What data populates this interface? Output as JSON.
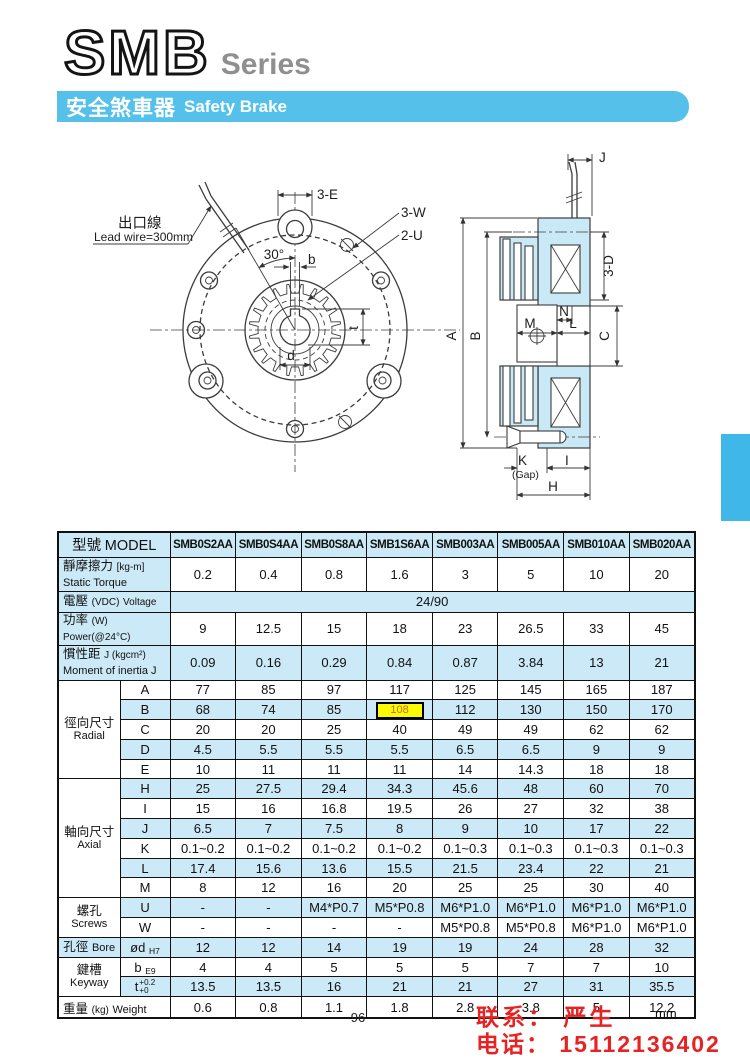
{
  "header": {
    "series": "SMB",
    "series_suffix": "Series",
    "banner_zh": "安全煞車器",
    "banner_en": "Safety Brake"
  },
  "drawings": {
    "lead_wire_label_zh": "出口線",
    "lead_wire_label_en": "Lead wire=300mm",
    "front_view": {
      "dim_3e": "3-E",
      "dim_3w": "3-W",
      "dim_2u": "2-U",
      "angle_30": "30°",
      "dim_b": "b",
      "dim_d": "d",
      "dim_t": "t"
    },
    "section_view": {
      "dim_j": "J",
      "dim_3d": "3-D",
      "dim_a": "A",
      "dim_b": "B",
      "dim_n": "N",
      "dim_m": "M",
      "dim_l": "L",
      "dim_c": "C",
      "dim_k": "K",
      "gap": "(Gap)",
      "dim_i": "I",
      "dim_h": "H"
    }
  },
  "table": {
    "header": {
      "zh": "型號",
      "en": "MODEL"
    },
    "models": [
      "SMB0S2AA",
      "SMB0S4AA",
      "SMB0S8AA",
      "SMB1S6AA",
      "SMB003AA",
      "SMB005AA",
      "SMB010AA",
      "SMB020AA"
    ],
    "spec_rows": [
      {
        "id": "static-torque",
        "label": {
          "zh": "靜摩擦力",
          "unit": "[kg-m]",
          "en": "Static Torque",
          "two_line": true
        },
        "values": [
          "0.2",
          "0.4",
          "0.8",
          "1.6",
          "3",
          "5",
          "10",
          "20"
        ]
      },
      {
        "id": "voltage",
        "label": {
          "zh": "電壓",
          "unit": "(VDC)",
          "en": "Voltage"
        },
        "span_value": "24/90"
      },
      {
        "id": "power",
        "label": {
          "zh": "功率",
          "unit": "(W)",
          "en": "Power(@24°C)"
        },
        "values": [
          "9",
          "12.5",
          "15",
          "18",
          "23",
          "26.5",
          "33",
          "45"
        ]
      },
      {
        "id": "inertia",
        "label": {
          "zh": "慣性距",
          "unit": "J (kgcm²)",
          "en": "Moment of inertia J",
          "two_line": true
        },
        "values": [
          "0.09",
          "0.16",
          "0.29",
          "0.84",
          "0.87",
          "3.84",
          "13",
          "21"
        ]
      }
    ],
    "groups": [
      {
        "zh": "徑向尺寸",
        "en": "Radial",
        "rows": [
          {
            "key": "A",
            "values": [
              "77",
              "85",
              "97",
              "117",
              "125",
              "145",
              "165",
              "187"
            ]
          },
          {
            "key": "B",
            "values": [
              "68",
              "74",
              "85",
              "108",
              "112",
              "130",
              "150",
              "170"
            ],
            "highlight": 3
          },
          {
            "key": "C",
            "values": [
              "20",
              "20",
              "25",
              "40",
              "49",
              "49",
              "62",
              "62"
            ]
          },
          {
            "key": "D",
            "values": [
              "4.5",
              "5.5",
              "5.5",
              "5.5",
              "6.5",
              "6.5",
              "9",
              "9"
            ]
          },
          {
            "key": "E",
            "values": [
              "10",
              "11",
              "11",
              "11",
              "14",
              "14.3",
              "18",
              "18"
            ]
          }
        ]
      },
      {
        "zh": "軸向尺寸",
        "en": "Axial",
        "rows": [
          {
            "key": "H",
            "values": [
              "25",
              "27.5",
              "29.4",
              "34.3",
              "45.6",
              "48",
              "60",
              "70"
            ]
          },
          {
            "key": "I",
            "values": [
              "15",
              "16",
              "16.8",
              "19.5",
              "26",
              "27",
              "32",
              "38"
            ]
          },
          {
            "key": "J",
            "values": [
              "6.5",
              "7",
              "7.5",
              "8",
              "9",
              "10",
              "17",
              "22"
            ]
          },
          {
            "key": "K",
            "values": [
              "0.1~0.2",
              "0.1~0.2",
              "0.1~0.2",
              "0.1~0.2",
              "0.1~0.3",
              "0.1~0.3",
              "0.1~0.3",
              "0.1~0.3"
            ]
          },
          {
            "key": "L",
            "values": [
              "17.4",
              "15.6",
              "13.6",
              "15.5",
              "21.5",
              "23.4",
              "22",
              "21"
            ]
          },
          {
            "key": "M",
            "values": [
              "8",
              "12",
              "16",
              "20",
              "25",
              "25",
              "30",
              "40"
            ]
          }
        ]
      },
      {
        "zh": "螺孔",
        "en": "Screws",
        "rows": [
          {
            "key": "U",
            "values": [
              "-",
              "-",
              "M4*P0.7",
              "M5*P0.8",
              "M6*P1.0",
              "M6*P1.0",
              "M6*P1.0",
              "M6*P1.0"
            ]
          },
          {
            "key": "W",
            "values": [
              "-",
              "-",
              "-",
              "-",
              "M5*P0.8",
              "M5*P0.8",
              "M6*P1.0",
              "M6*P1.0"
            ]
          }
        ]
      },
      {
        "zh": "孔徑",
        "en": "Bore",
        "inline": true,
        "rows": [
          {
            "key": "ød",
            "sub": "H7",
            "values": [
              "12",
              "12",
              "14",
              "19",
              "19",
              "24",
              "28",
              "32"
            ]
          }
        ]
      },
      {
        "zh": "鍵槽",
        "en": "Keyway",
        "rows": [
          {
            "key": "b",
            "sub": "E9",
            "values": [
              "4",
              "4",
              "5",
              "5",
              "5",
              "7",
              "7",
              "10"
            ]
          },
          {
            "key": "t",
            "tol_top": "+0.2",
            "tol_bot": "+0",
            "values": [
              "13.5",
              "13.5",
              "16",
              "21",
              "21",
              "27",
              "31",
              "35.5"
            ]
          }
        ]
      }
    ],
    "weight_row": {
      "zh": "重量",
      "unit": "(kg)",
      "en": "Weight",
      "values": [
        "0.6",
        "0.8",
        "1.1",
        "1.8",
        "2.8",
        "3.8",
        "5",
        "12.2"
      ]
    }
  },
  "footer": {
    "page_number": "96",
    "unit": "mm",
    "contact_name": "联系： 严生",
    "contact_phone": "电话： 15112136402"
  },
  "colors": {
    "banner_blue": "#55c1ea",
    "tab_blue": "#3fb8e9",
    "row_shade": "#cce9f7",
    "highlight_yellow": "#fcfc00",
    "highlight_text": "#c06a28",
    "contact_red": "#e62222",
    "drawing_fill": "#c9e9f7"
  }
}
